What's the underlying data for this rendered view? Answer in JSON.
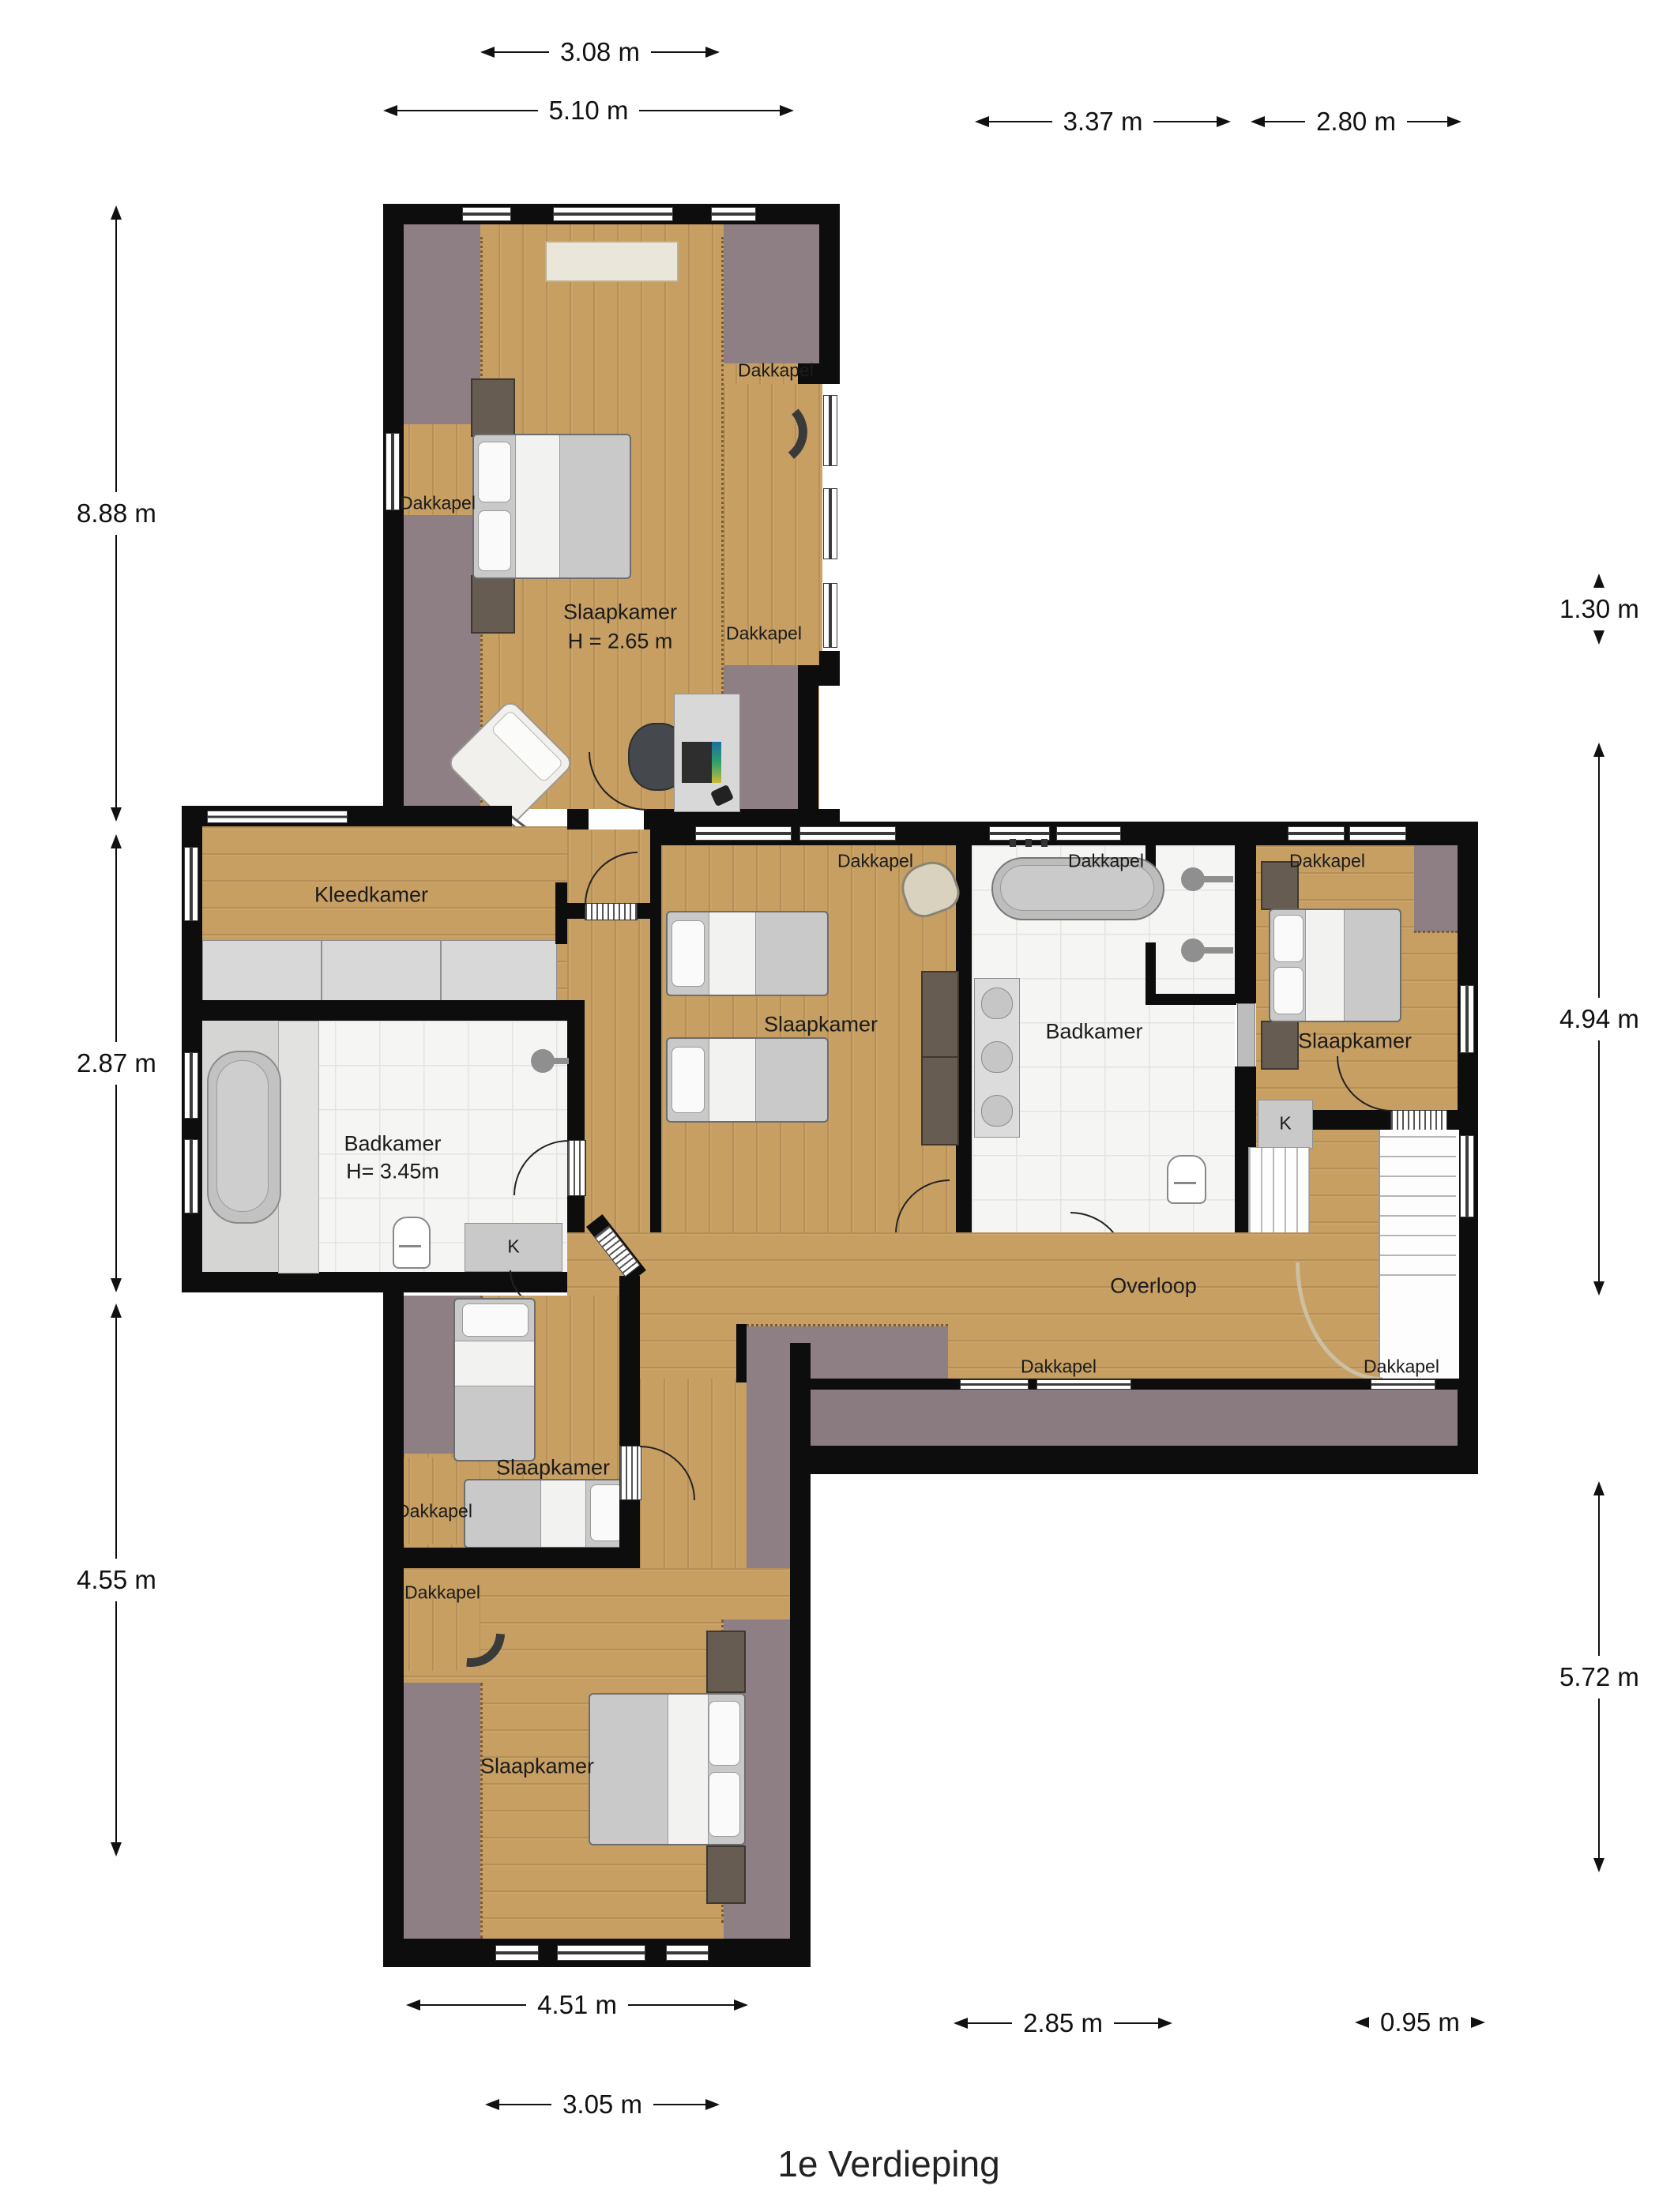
{
  "title": "1e Verdieping",
  "floor_plan": {
    "rooms": {
      "bedroom_north": {
        "name": "Slaapkamer",
        "height": "H = 2.65 m"
      },
      "dressing_room": {
        "name": "Kleedkamer"
      },
      "bathroom_west": {
        "name": "Badkamer",
        "height": "H= 3.45m"
      },
      "bedroom_middle": {
        "name": "Slaapkamer"
      },
      "bathroom_middle": {
        "name": "Badkamer"
      },
      "bedroom_east": {
        "name": "Slaapkamer"
      },
      "landing": {
        "name": "Overloop"
      },
      "bedroom_southwest": {
        "name": "Slaapkamer"
      },
      "bedroom_south": {
        "name": "Slaapkamer"
      }
    },
    "annotations": {
      "dormer": "Dakkapel",
      "closet": "K"
    },
    "dimensions": {
      "top": [
        "3.08 m",
        "5.10 m",
        "3.37 m",
        "2.80 m"
      ],
      "left": [
        "8.88 m",
        "2.87 m",
        "4.55 m"
      ],
      "right": [
        "1.30 m",
        "4.94 m",
        "5.72 m"
      ],
      "bottom": [
        "4.51 m",
        "2.85 m",
        "0.95 m",
        "3.05 m"
      ]
    },
    "colors": {
      "wall": "#0d0d0d",
      "floor_wood": "#c79f63",
      "roof_mauve": "#8d7f83",
      "bathroom_tile": "#f5f5f3",
      "furniture_gray": "#c9c9c9",
      "cabinet_dark": "#665c52"
    }
  }
}
